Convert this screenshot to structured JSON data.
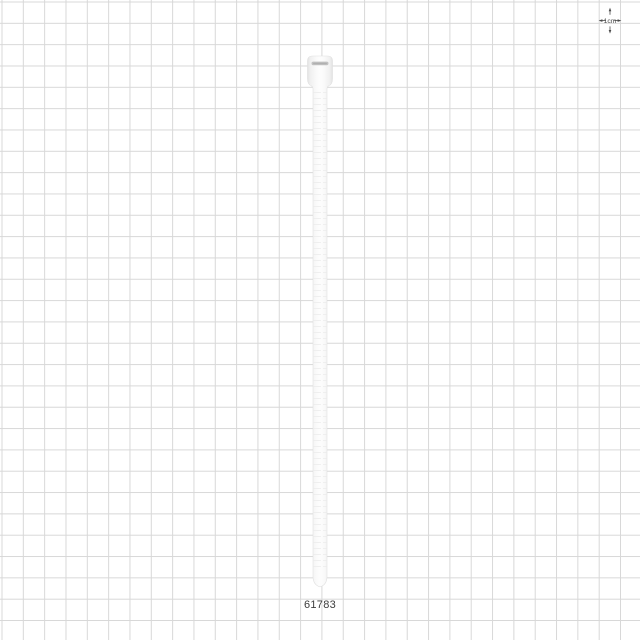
{
  "product": {
    "part_number": "61783",
    "description": "white cable tie shown vertically on measurement grid"
  },
  "scale_indicator": {
    "label": "1cm"
  },
  "grid": {
    "cell_represents": "1cm",
    "line_color": "#d8d8d8",
    "background_color": "#ffffff"
  },
  "colors": {
    "tie_body": "#fdfdfd",
    "tie_edge": "#e2e2e2",
    "slot": "#c1c1c1",
    "slot_inner": "#b0b0b0",
    "part_number_text": "#3c3c3c",
    "scale_marks": "#4a4a4a"
  }
}
